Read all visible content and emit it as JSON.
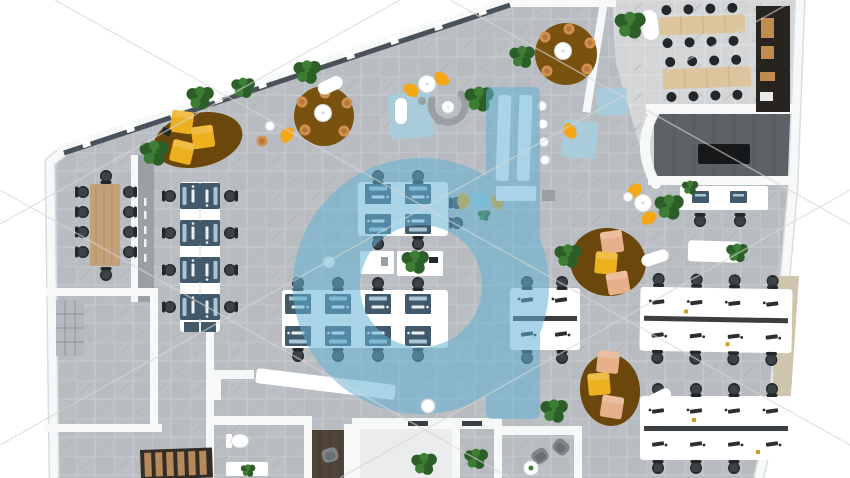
{
  "meta": {
    "kind": "3d-office-floor-plan-top-view-render",
    "style": "watermarked stock render, top-down axonometric office interior"
  },
  "palette": {
    "white": "#ffffff",
    "wall": "#f7f8f8",
    "wallShadow": "#dadddf",
    "floor": "#b8bcc0",
    "floorAlt": "#bfc3c7",
    "grout": "#c9cdd1",
    "streak": "#aab0b4",
    "floorLight": "#d3d5d7",
    "groutLight": "#dfe1e3",
    "glassFrame": "#49525a",
    "grayWall": "#9aa1a5",
    "tanWall": "#cfc4ac",
    "kitchen": "#27231f",
    "shelfWood": "#c08c4e",
    "darkFloor": "#5d6266",
    "darkPlank": "#53585c",
    "shelfBlack": "#16181a",
    "locker": "#b3b9bc",
    "lockerLine": "#8f969a",
    "stairs": "#332d28",
    "tread": "#b5895a",
    "booth": "#4f4437",
    "boothPlank": "#443a2f",
    "woodTable": "#c2a078",
    "woodGrain": "#a9865c",
    "cafeTable": "#dcc49c",
    "cafePlank": "#c9ab7e",
    "chair": "#24282b",
    "chairSeat": "#3c4246",
    "mat": "#41596a",
    "screen": "#a7c6d2",
    "kb": "#2b2f33",
    "divider": "#3a3e41",
    "sticky": "#caa21f",
    "slot": "#3a3f43",
    "wicker": "#d2924f",
    "wickerIn": "#b5763a",
    "orange": "#f5a716",
    "cubeTan": "#e7b08a",
    "cubeYellow": "#edb01f",
    "rug": "#7a520f",
    "rugD": "#6b470c",
    "plant": "#3e7d35",
    "plantD": "#2c5f27",
    "blueRug": "#a6cede",
    "blueTable": "#9fc8da",
    "watermark": "#63b1d4",
    "wmLine": "#d6d6d6",
    "grayItem": "#99a0a4",
    "tub": "#7e8487",
    "tubIn": "#696f72",
    "tableDot": "#d9dbdc"
  },
  "watermark": {
    "glyph": "d",
    "color": "#63b1d4",
    "opacity": 0.55,
    "diagonal_line_count": 6
  },
  "scene": {
    "rooms": [
      "open-office-floor",
      "conference-room",
      "storage-room",
      "corridor-stairwell",
      "restroom",
      "phone-booth",
      "meeting-pod",
      "lounge-room",
      "cafeteria",
      "kitchen",
      "media-room"
    ],
    "desk_clusters": [
      {
        "id": "left-vertical-bank",
        "workstations": 8
      },
      {
        "id": "center-north-bank",
        "workstations": 4
      },
      {
        "id": "center-south-bank",
        "workstations": 8
      },
      {
        "id": "center-east-bank",
        "workstations": 4
      },
      {
        "id": "east-upper-bank",
        "workstations": 8
      },
      {
        "id": "east-lower-bank",
        "workstations": 8
      },
      {
        "id": "kitchen-side-desks",
        "workstations": 2
      }
    ],
    "seating": {
      "task_chairs": 43,
      "conference_chairs": 10,
      "cafeteria_stools": 16,
      "wicker_chairs": 12,
      "orange_shell_chairs": 7,
      "pouf_cubes": 9,
      "lounge_tub_chairs": 3,
      "white_stools": 7
    },
    "decor": {
      "plants": 17,
      "round_meeting_rugs": 2,
      "organic_lounge_rugs": 3,
      "blue_floor_mats": 3
    }
  }
}
